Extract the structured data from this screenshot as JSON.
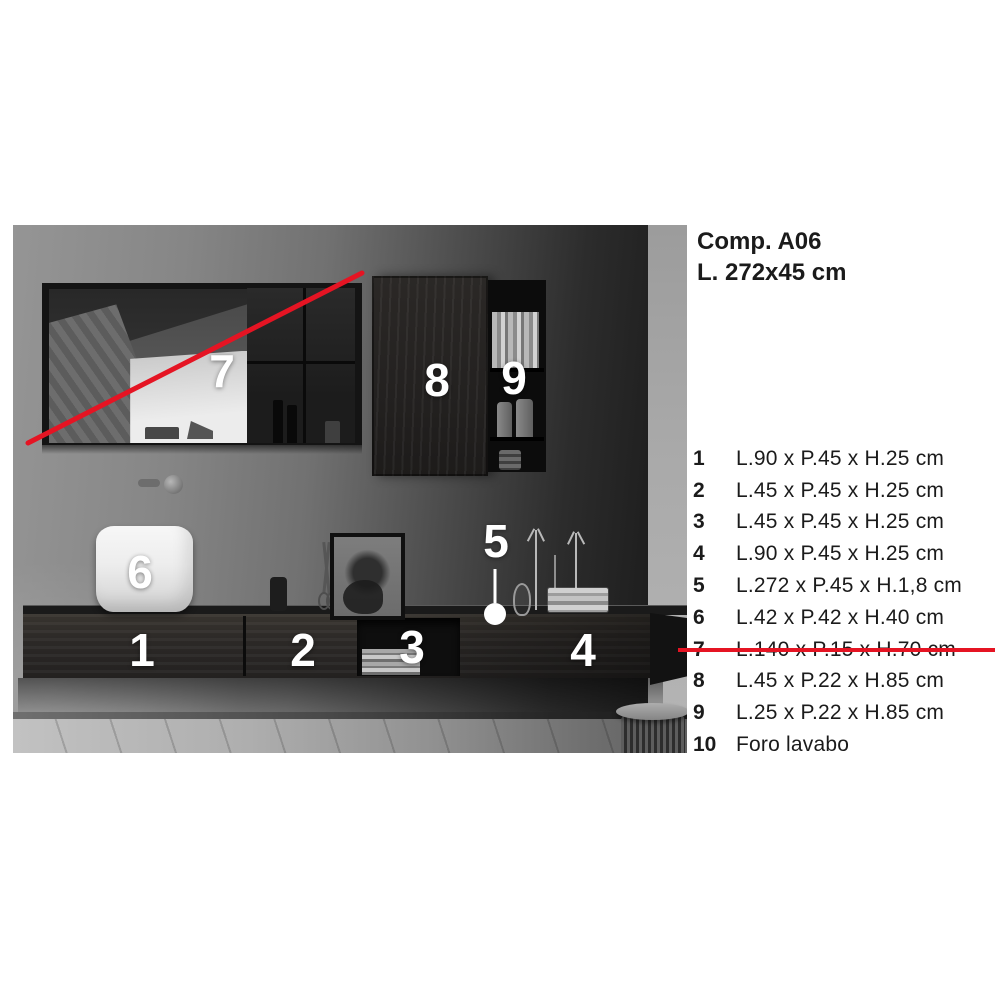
{
  "header": {
    "title": "Comp. A06",
    "subtitle": "L. 272x45 cm"
  },
  "spec_list": {
    "items": [
      {
        "num": "1",
        "text": "L.90 x P.45 x H.25 cm",
        "struck": false
      },
      {
        "num": "2",
        "text": "L.45 x P.45 x H.25 cm",
        "struck": false
      },
      {
        "num": "3",
        "text": "L.45 x P.45 x H.25 cm",
        "struck": false
      },
      {
        "num": "4",
        "text": "L.90 x P.45 x H.25 cm",
        "struck": false
      },
      {
        "num": "5",
        "text": "L.272 x P.45 x H.1,8 cm",
        "struck": false
      },
      {
        "num": "6",
        "text": "L.42 x P.42 x H.40 cm",
        "struck": false
      },
      {
        "num": "7",
        "text": "L.140 x P.15 x H.70 cm",
        "struck": true
      },
      {
        "num": "8",
        "text": "L.45 x P.22 x H.85 cm",
        "struck": false
      },
      {
        "num": "9",
        "text": "L.25 x P.22 x H.85 cm",
        "struck": false
      },
      {
        "num": "10",
        "text": "Foro lavabo",
        "struck": false
      }
    ]
  },
  "photo_labels": {
    "l1": "1",
    "l2": "2",
    "l3": "3",
    "l4": "4",
    "l5": "5",
    "l6": "6",
    "l7": "7",
    "l8": "8",
    "l9": "9"
  },
  "colors": {
    "strike_red": "#e51423",
    "label_white": "#ffffff"
  }
}
